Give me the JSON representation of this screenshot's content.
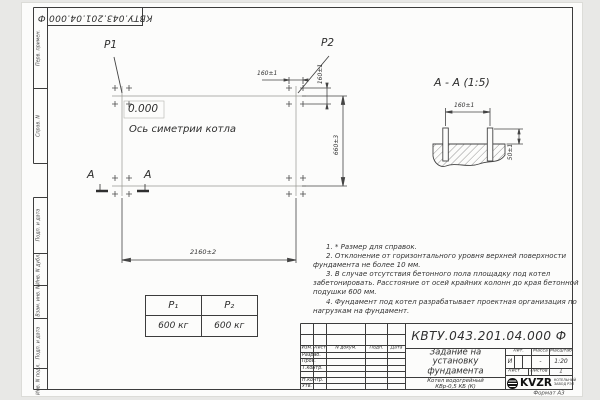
{
  "colors": {
    "ink": "#3a3a3a",
    "paper": "#fcfcfb",
    "logo": "#111111"
  },
  "drawing": {
    "designation": "КВТУ.043.201.04.000  Ф",
    "corner_designation": "КВТУ.043.201.04.000  Ф",
    "format_label": "Формат А3"
  },
  "margin_fields": {
    "perv": "Перв. примен.",
    "sprav": "Справ. N",
    "podp1": "Подп. и дата",
    "inv_dubl": "Инв. N дубл.",
    "vzam": "Взам. инв. N",
    "podp2": "Подп. и дата",
    "inv_podl": "Инв. N подл."
  },
  "plan": {
    "p1_label": "P1",
    "p2_label": "P2",
    "elevation": "0.000",
    "axis_label": "Ось симетрии котла",
    "dim_bolt_h": "160±1",
    "dim_bolt_v": "160±1",
    "dim_height": "660±3",
    "dim_width": "2160±2",
    "section_letter_left": "А",
    "section_letter_right": "А"
  },
  "section_view": {
    "title": "А - А (1:5)",
    "dim_span": "160±1",
    "dim_protrusion": "50±1"
  },
  "load_table": {
    "col1_header": "P₁",
    "col2_header": "P₂",
    "col1_value": "600 кг",
    "col2_value": "600 кг"
  },
  "notes": [
    "1. * Размер для справок.",
    "2. Отклонение от горизонтального уровня верхней поверхности фундамента не более 10 мм.",
    "3. В случае отсутствия бетонного пола площадку под котел забетонировать. Расстояние от осей крайних колонн до края бетонной подушки 600 мм.",
    "4. Фундамент под котел разрабатывает проектная организация по нагрузкам на фундамент."
  ],
  "title_block": {
    "headers": {
      "izm": "Изм.",
      "list": "Лист",
      "ndoc": "N докум.",
      "podp": "Подп.",
      "data": "Дата",
      "lit": "Лит.",
      "massa": "Масса",
      "scale": "Масштаб",
      "sheet": "Лист",
      "sheets": "Листов"
    },
    "rows": {
      "razrab": "Разраб.",
      "prov": "Пров.",
      "tkontr": "Т.контр.",
      "nkontr": "Н.контр.",
      "utv": "Утв."
    },
    "title": "Задание на\nустановку\nфундамента",
    "product": "Котел водогрейный\nКВр-0,5 КБ  (К)",
    "lit_value": "И",
    "mass_value": "-",
    "scale_value": "1:20",
    "sheets_value": "1",
    "logo": {
      "name": "KVZR",
      "caption": "КОТЕЛЬНЫЙ\nЗАВОД РЭП"
    }
  }
}
